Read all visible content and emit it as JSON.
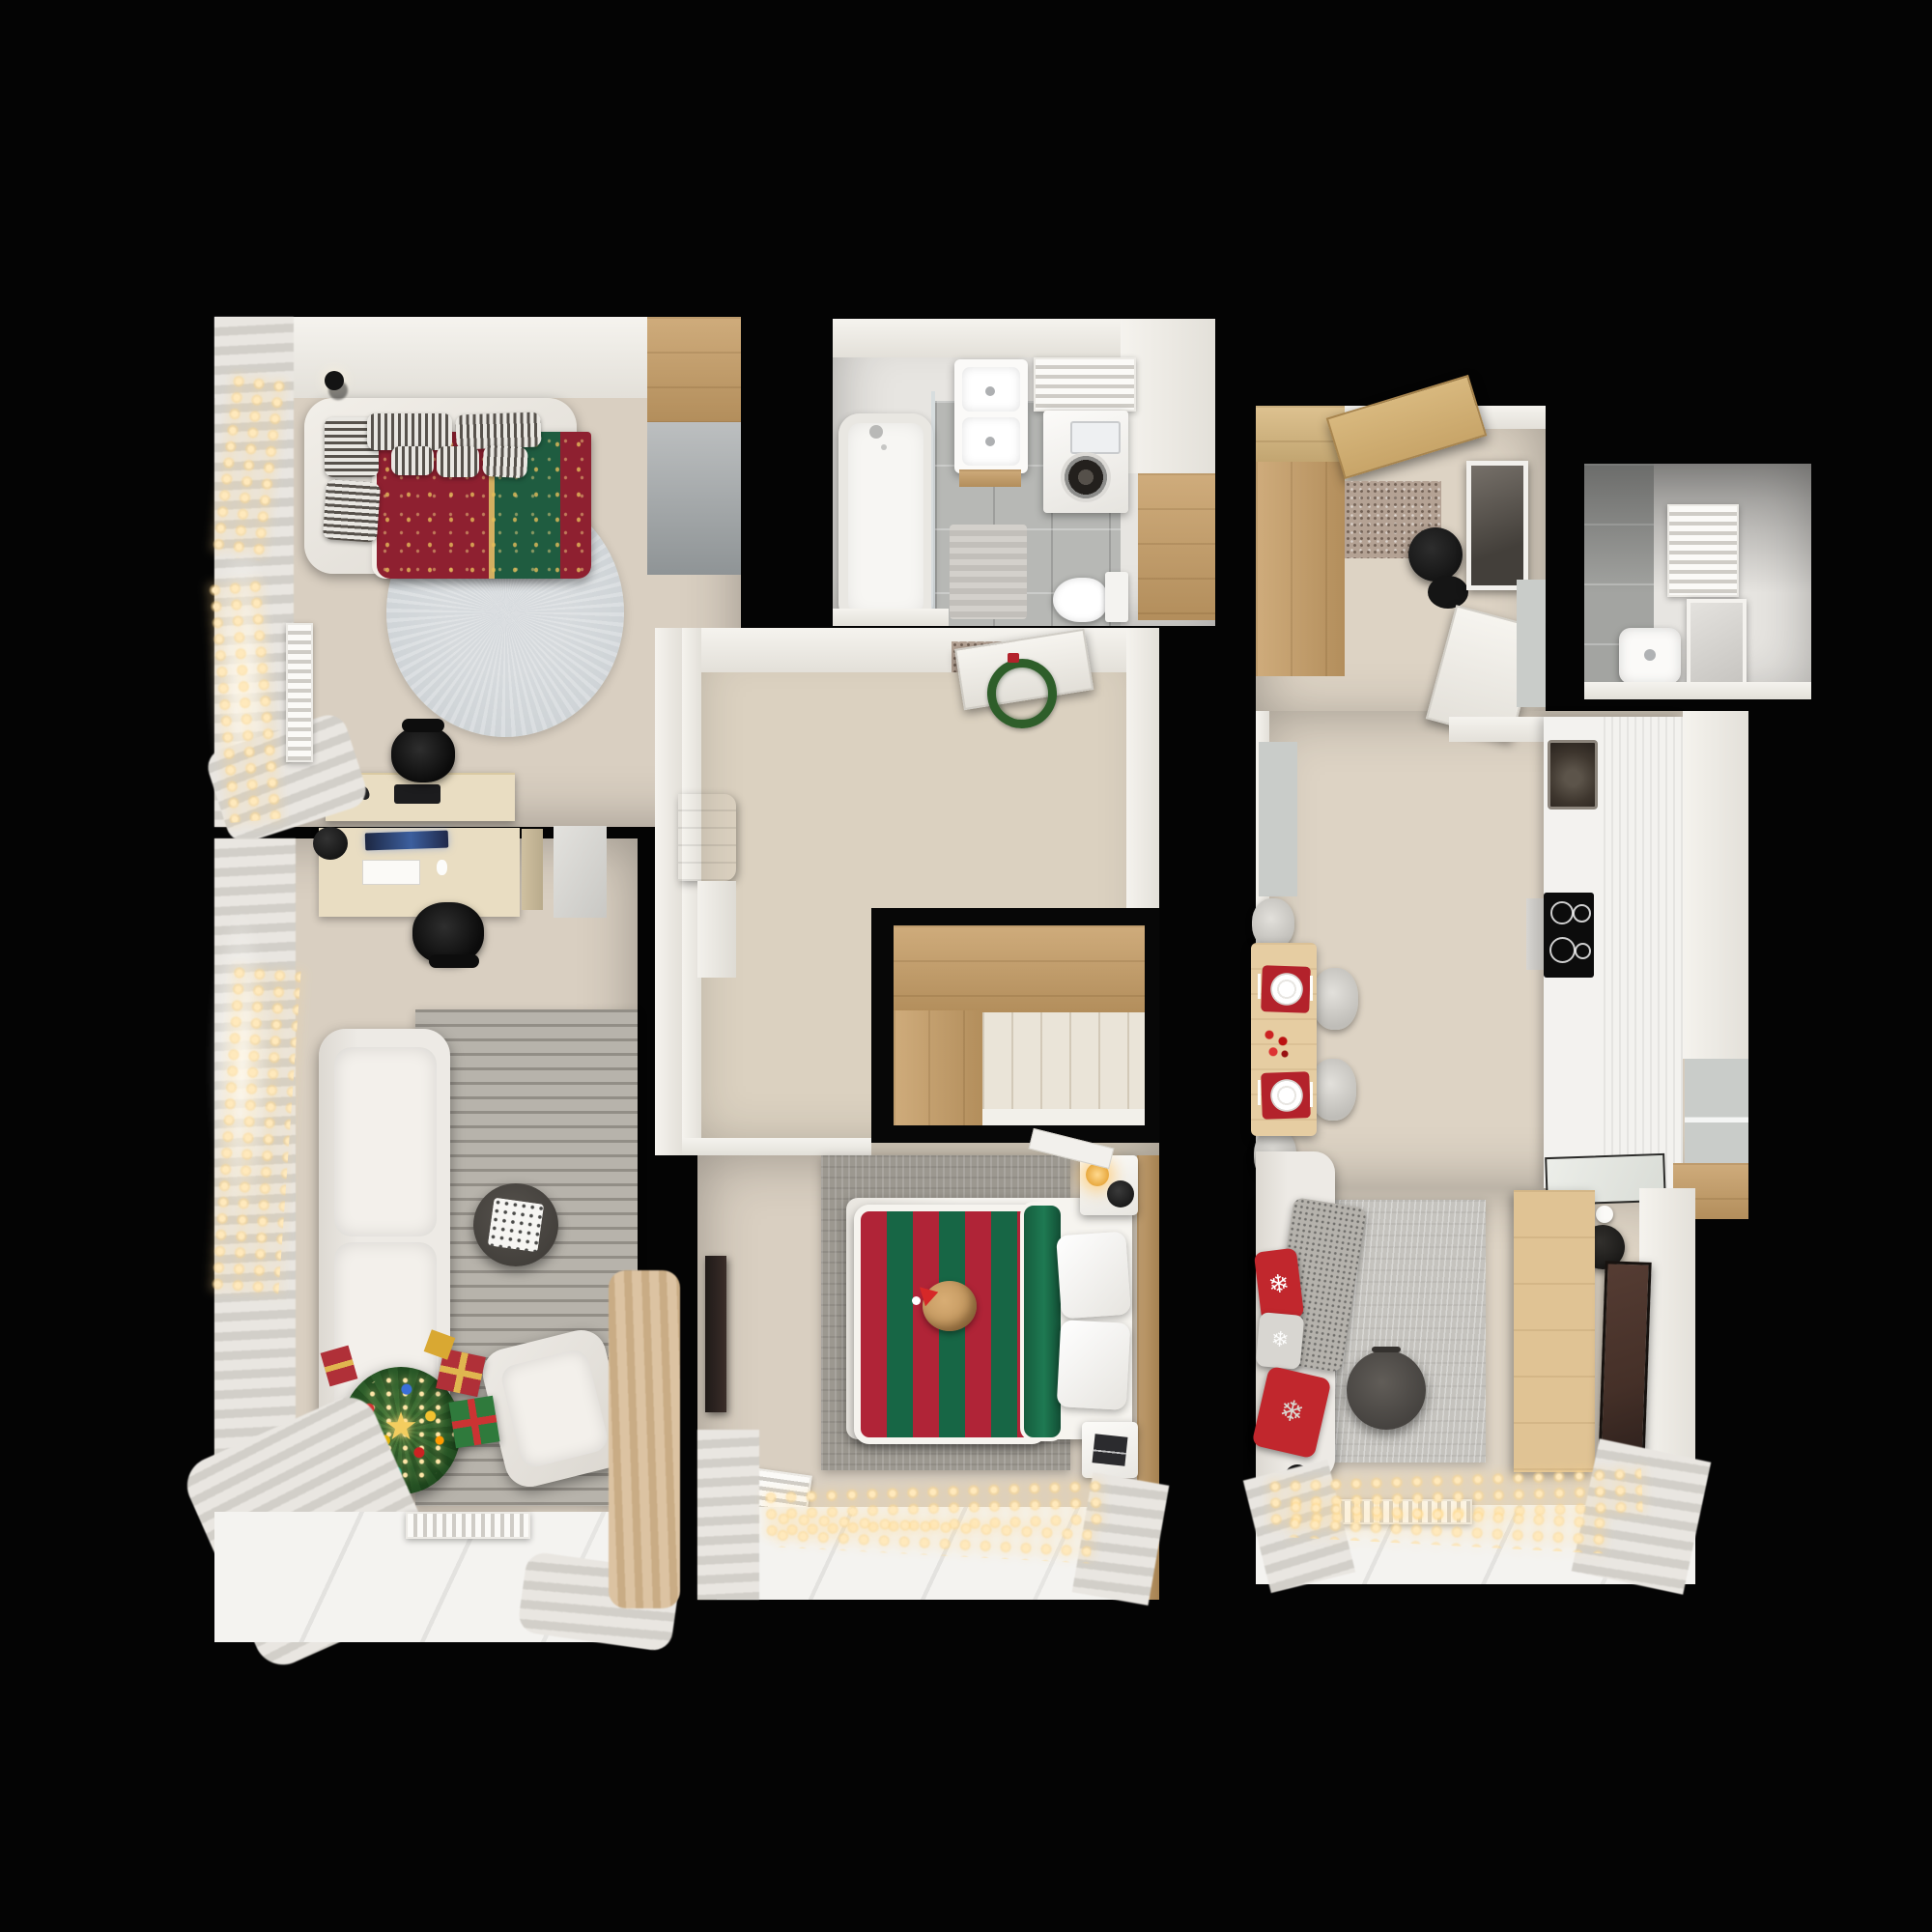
{
  "scene": {
    "title": "Top-down 3D render floor plan of a two-bedroom apartment with Christmas decorations",
    "background": "#040404",
    "view": "orthographic top-down doll-house render",
    "decor_theme": "christmas"
  },
  "glyphs": {
    "snowflake": "❄",
    "star": "★"
  },
  "palette": {
    "bg": "#040404",
    "wall": "#f5f3ee",
    "wallDim": "#e3e0d9",
    "floorWarm": "#d9cfc1",
    "floorHall": "#dbd1c0",
    "floorKitchen": "#ddd3c4",
    "floorPale": "#eae4d8",
    "tileGray": "#b7b8b5",
    "tileLight": "#e7e5e1",
    "wcGray": "#a3a4a1",
    "wood": "#c79e66",
    "woodLight": "#d8b87e",
    "woodDark": "#b8905a",
    "deskWood": "#e9ddc2",
    "tableWood": "#e6cda2",
    "sofaWhite": "#edeae5",
    "cushion": "#f3f0eb",
    "rugStripe": "#b7b3ab",
    "rugDark": "#8f8b84",
    "rugBed": "#9c9890",
    "rugRight": "#c5c3be",
    "rugRound": "#cfd4d7",
    "chairBlack": "#161616",
    "chairGray": "#d7d5d0",
    "duvetRed": "#8e2030",
    "duvetGreen": "#1f5c40",
    "duvetGold": "#d4af60",
    "stripeRed": "#b02437",
    "stripeGreen": "#176645",
    "pillowRed": "#c1272d",
    "pillowStripe": "#57524c",
    "tree": "#2a5a28",
    "treeDark": "#1d431c",
    "giftRed": "#b03038",
    "giftGreen": "#2f7a3c",
    "ribbonGold": "#e0b64f",
    "lightWarm": "#ffe9bc",
    "lightGlow": "#ffd88c",
    "dark": "#0c0c0c",
    "steel": "#b9b7b3",
    "sinkDark": "#3e362e",
    "tvBrown": "#453028",
    "counter": "#f3f2ef",
    "grayPanel": "#c9ccc9",
    "mirror": "#5f5a54",
    "matSpeckle": "#b4a294",
    "curtain": "#e9e6e1",
    "curtainDim": "#d2cfc9",
    "curtainBeige": "#dcc3a2",
    "white": "#fafaf8",
    "catFur": "#c59a62"
  },
  "rooms": [
    {
      "id": "bedroom-1",
      "label": "bedroom-study",
      "furniture": [
        "corner double bed",
        "ornate red-green folk duvet",
        "striped gray pillows",
        "round gray rug",
        "ceiling spotlight",
        "desk with keyboard",
        "black office chair",
        "wardrobe wood and gray",
        "window curtains",
        "fairy lights",
        "panel radiator"
      ]
    },
    {
      "id": "living-room",
      "label": "living-room-office",
      "furniture": [
        "desk with laptop and lamp",
        "black office chair",
        "white two-seat sofa",
        "striped gray rug",
        "round dark coffee table with tray",
        "white armchair",
        "decorated christmas tree",
        "gift boxes",
        "window curtains",
        "fairy lights",
        "window sill radiator",
        "beige curtain"
      ]
    },
    {
      "id": "bathroom",
      "label": "bathroom",
      "furniture": [
        "bathtub with shower screen",
        "vanity washbasin",
        "towel radiator",
        "washing machine",
        "toilet",
        "bath mat",
        "tall wooden cabinet",
        "gray tile floor"
      ]
    },
    {
      "id": "hallway",
      "label": "hallway",
      "furniture": [
        "entrance door with christmas wreath",
        "speckled doormat",
        "white AC cabinet",
        "built-in L-shaped wooden closet",
        "plank alcove"
      ]
    },
    {
      "id": "bedroom-2",
      "label": "master-bedroom",
      "furniture": [
        "double bed",
        "red-green striped duvet",
        "cat in santa hat",
        "white pillows",
        "two white nightstands",
        "glowing table lamp",
        "black speaker",
        "wall tv",
        "gray rug",
        "panel radiator",
        "fairy lights",
        "open white door",
        "wood wall panel"
      ]
    },
    {
      "id": "kitchen-living",
      "label": "entry-kitchen-living",
      "furniture": [
        "entry wardrobe",
        "open wooden front door",
        "speckled doormat",
        "black stool",
        "framed mirror",
        "open white door",
        "dining table",
        "red placemats with plates",
        "four gray chairs",
        "kitchen counter",
        "dark sink",
        "induction hob",
        "oven front",
        "glass cabinet",
        "wood shelf",
        "tv console",
        "wall tv",
        "white sofa",
        "red snowflake pillows",
        "gray throw",
        "round side table",
        "gray rug",
        "fairy lights",
        "window sill"
      ]
    },
    {
      "id": "wc",
      "label": "small-wc",
      "furniture": [
        "washbasin",
        "mirror",
        "towel radiator",
        "gray tile floor"
      ]
    }
  ]
}
